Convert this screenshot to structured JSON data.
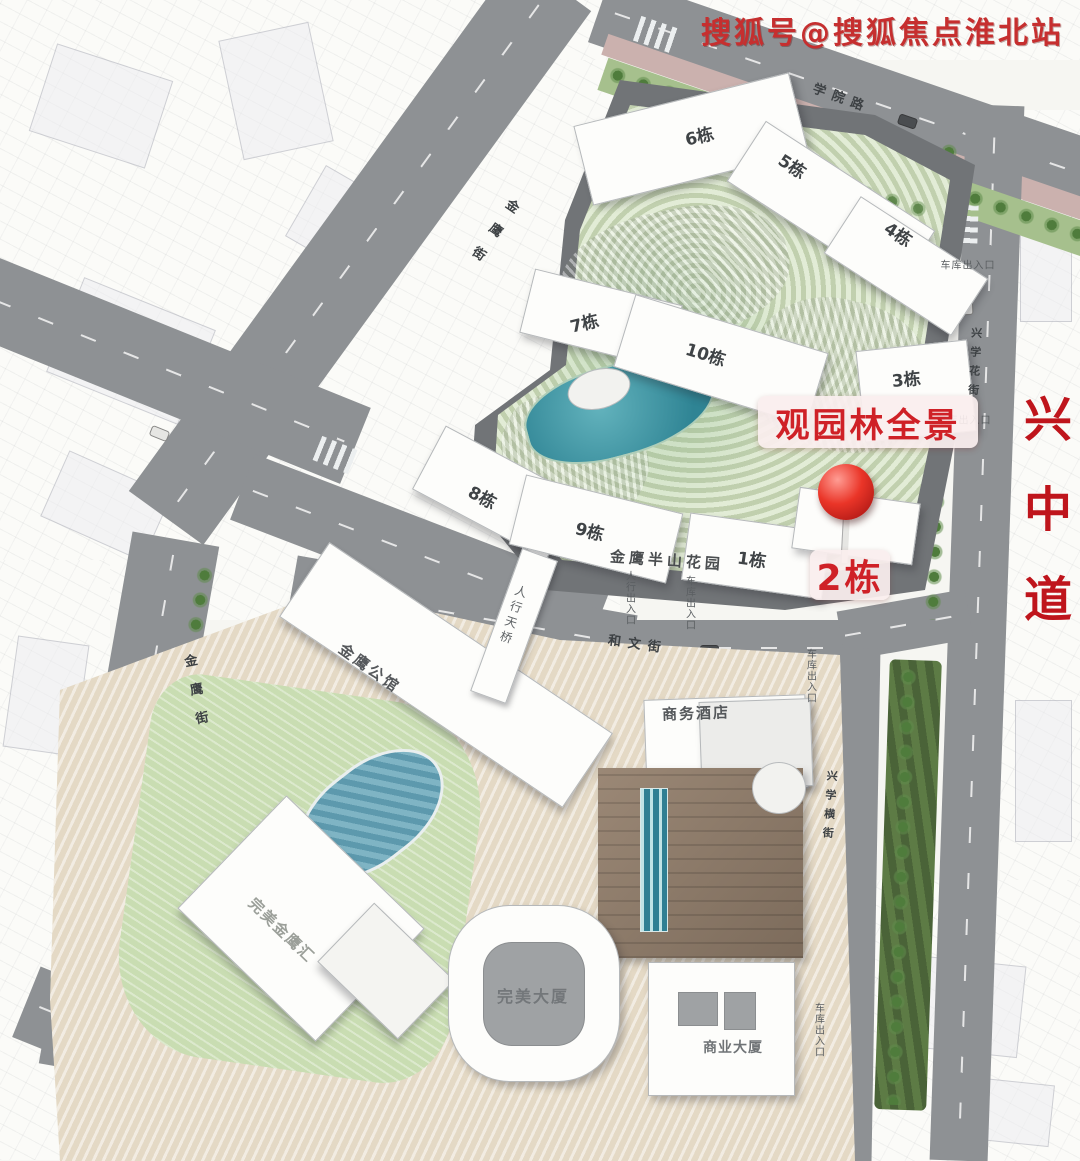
{
  "watermark": {
    "text": "搜狐号@搜狐焦点淮北站"
  },
  "annotation": {
    "banner_label": "观园林全景",
    "pin_building_label": "2栋",
    "pin_icon": "red-ball-location-pin",
    "accent_color": "#cf2127"
  },
  "arterial_road": {
    "name": "兴中道",
    "color": "#bf151c"
  },
  "upper_compound": {
    "name": "金鹰半山花园",
    "buildings": [
      {
        "id": "b6",
        "label": "6栋"
      },
      {
        "id": "b5",
        "label": "5栋"
      },
      {
        "id": "b4",
        "label": "4栋"
      },
      {
        "id": "b7",
        "label": "7栋"
      },
      {
        "id": "b10",
        "label": "10栋"
      },
      {
        "id": "b3",
        "label": "3栋"
      },
      {
        "id": "b8",
        "label": "8栋"
      },
      {
        "id": "b9",
        "label": "9栋"
      },
      {
        "id": "b1",
        "label": "1栋"
      }
    ]
  },
  "lower_complex": {
    "buildings": [
      {
        "id": "gongguan",
        "label": "金鹰公馆"
      },
      {
        "id": "business-hotel",
        "label": "商务酒店"
      },
      {
        "id": "perfect-mall",
        "label": "完美金鹰汇"
      },
      {
        "id": "perfect-tower",
        "label": "完美大厦"
      },
      {
        "id": "commercial-tower",
        "label": "商业大厦"
      }
    ]
  },
  "streets": [
    {
      "id": "xueyuan-road",
      "name": "学院路"
    },
    {
      "id": "jinying-upper",
      "name": "金鹰街"
    },
    {
      "id": "jinying-lower",
      "name": "金鹰街"
    },
    {
      "id": "hewen-street",
      "name": "和文街"
    },
    {
      "id": "xinxue-hua",
      "name": "兴学花街"
    },
    {
      "id": "xinxue-heng",
      "name": "兴学横街"
    }
  ],
  "bridge": {
    "name": "人行天桥"
  },
  "entrances": [
    {
      "label": "车库出入口"
    },
    {
      "label": "车库出入口"
    },
    {
      "label": "人行出入口"
    },
    {
      "label": "车库出入口"
    },
    {
      "label": "车库出入口"
    },
    {
      "label": "车库出入口"
    }
  ]
}
